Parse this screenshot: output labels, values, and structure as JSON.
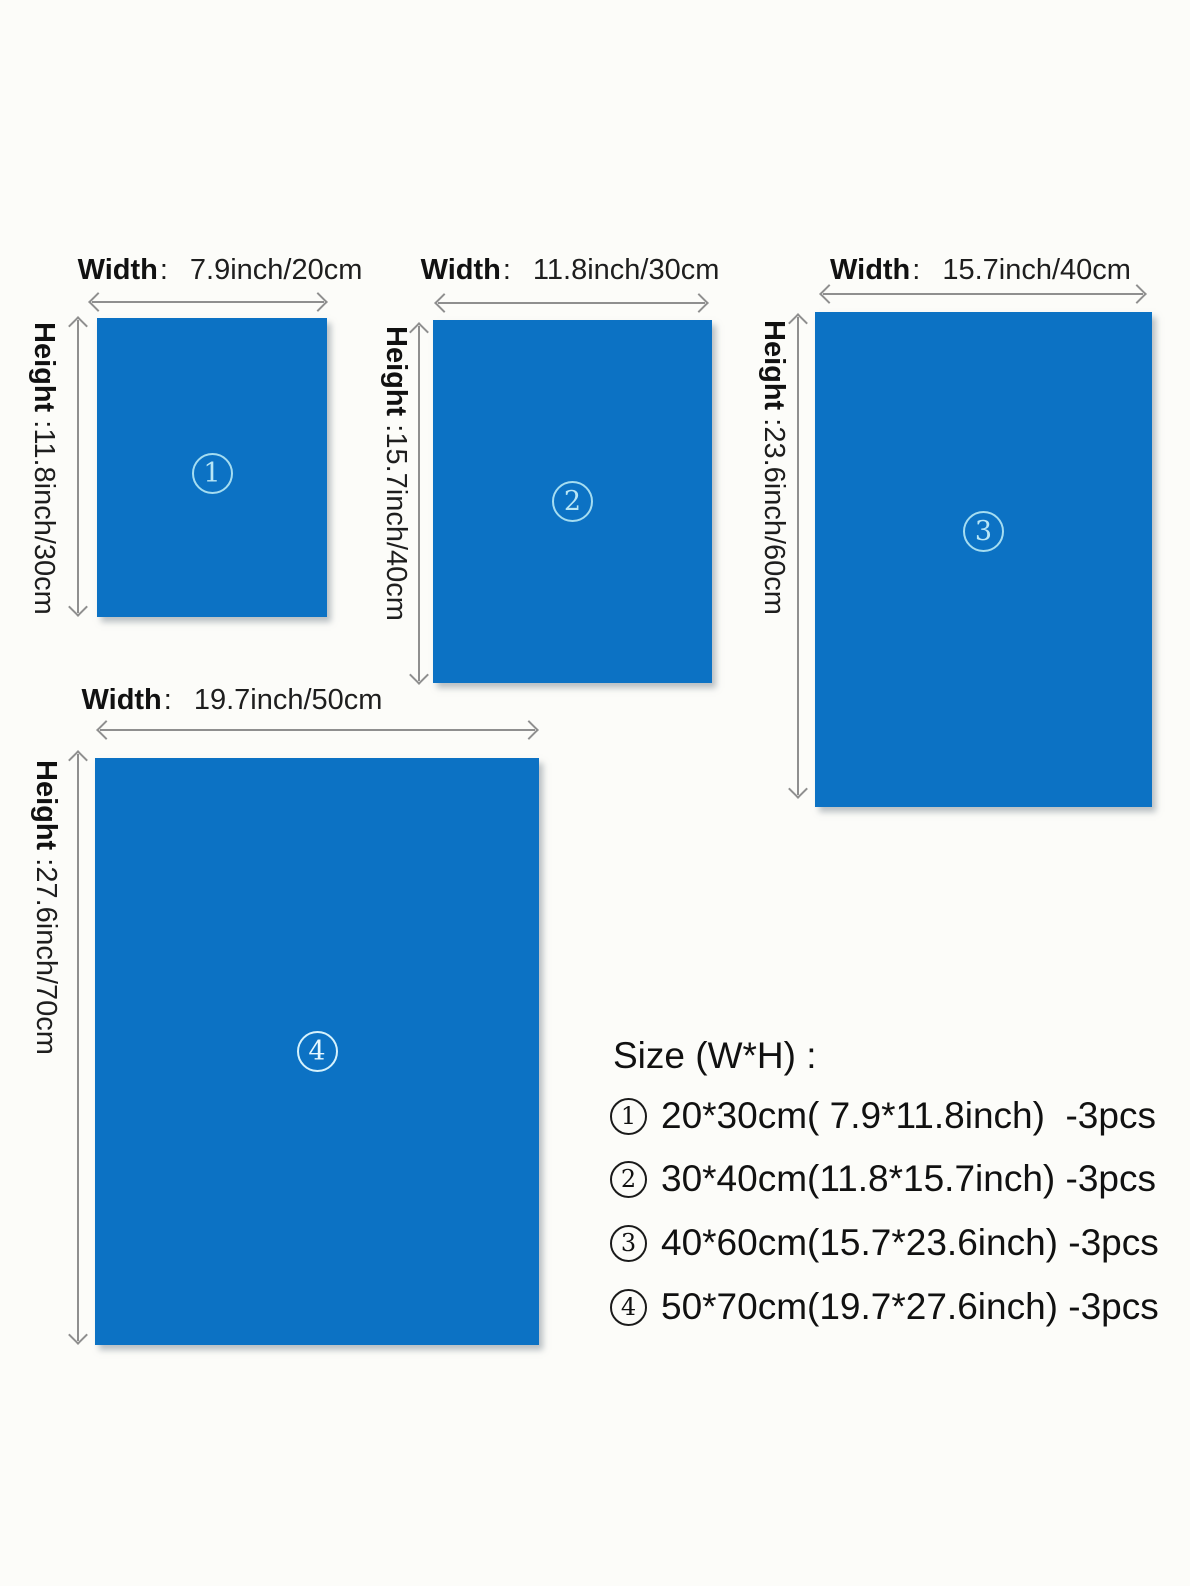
{
  "colors": {
    "swatch_blue": "#0c72c4",
    "dimension_arrow_gray": "#8f8f8f",
    "text_black": "#1a1a1a",
    "circle_on_swatch_cyan": "#a5ddf1",
    "background": "#fcfcf9"
  },
  "panels": [
    {
      "number": "1",
      "width_label": "Width",
      "width_sep": ":",
      "width_value": "7.9inch/20cm",
      "height_label": "Height",
      "height_sep": " :",
      "height_value": "11.8inch/30cm"
    },
    {
      "number": "2",
      "width_label": "Width",
      "width_sep": ":",
      "width_value": "11.8inch/30cm",
      "height_label": "Height",
      "height_sep": " :",
      "height_value": "15.7inch/40cm"
    },
    {
      "number": "3",
      "width_label": "Width",
      "width_sep": ":",
      "width_value": "15.7inch/40cm",
      "height_label": "Height",
      "height_sep": " :",
      "height_value": "23.6inch/60cm"
    },
    {
      "number": "4",
      "width_label": "Width",
      "width_sep": ":",
      "width_value": "19.7inch/50cm",
      "height_label": "Height",
      "height_sep": " :",
      "height_value": "27.6inch/70cm"
    }
  ],
  "legend": {
    "title": "Size (W*H) :",
    "items": [
      {
        "num": "1",
        "text": "20*30cm( 7.9*11.8inch)  -3pcs"
      },
      {
        "num": "2",
        "text": "30*40cm(11.8*15.7inch) -3pcs"
      },
      {
        "num": "3",
        "text": "40*60cm(15.7*23.6inch) -3pcs"
      },
      {
        "num": "4",
        "text": "50*70cm(19.7*27.6inch) -3pcs"
      }
    ]
  }
}
